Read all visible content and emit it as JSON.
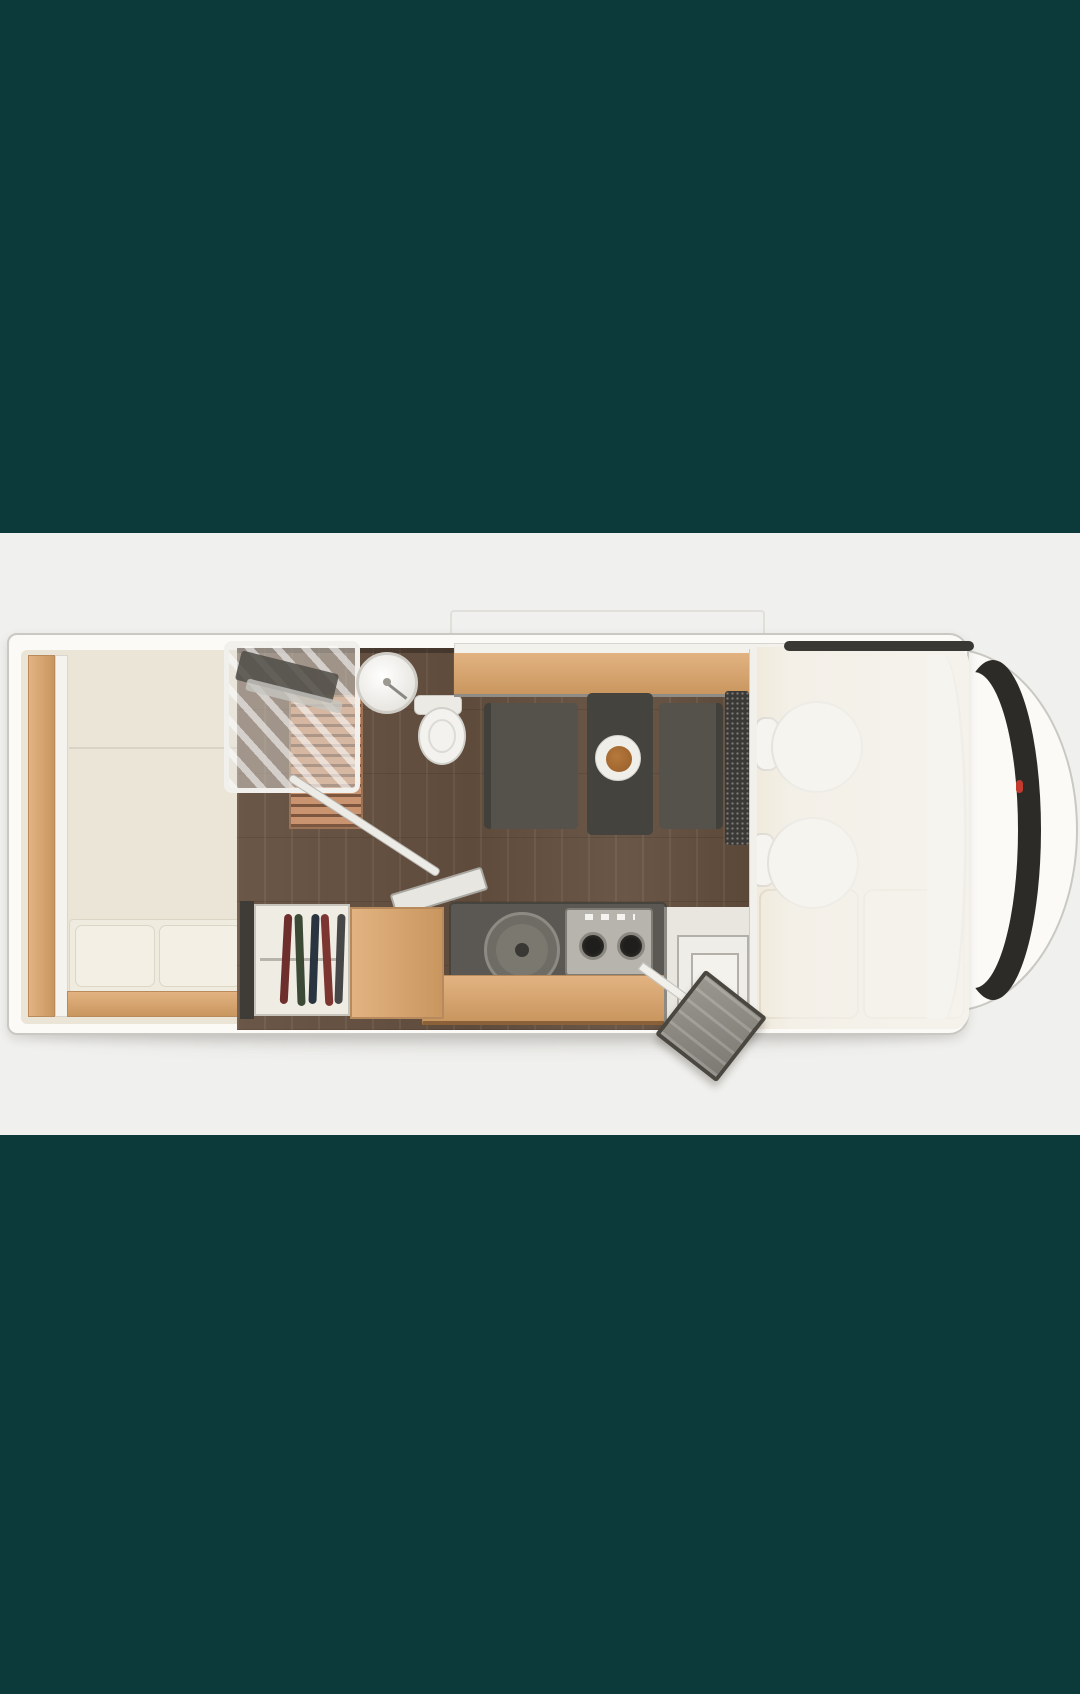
{
  "meta": {
    "title": "Motorhome floor plan, top-down 3D view"
  },
  "objects": [
    "rear-bed",
    "bed-pillows",
    "wardrobe",
    "shower",
    "washbasin",
    "toilet",
    "dinette-table",
    "dinette-benches",
    "overhead-counter",
    "kitchen-sink",
    "gas-stove",
    "kitchen-cabinet",
    "entry-door-open",
    "entry-step",
    "cab-swivel-seats",
    "cab-cushions",
    "dashboard",
    "windshield"
  ],
  "colors": {
    "teal": "#0c3a3b",
    "panel": "#f0f0ee",
    "body": "#fbfaf7",
    "body_line": "#c9c8c2",
    "interior_cream": "#ebe5d7",
    "bed": "#f0ebdf",
    "pillow": "#f3efe4",
    "pillow_line": "#dcd6c5",
    "oak": "#e2b381",
    "oak_deep": "#c9965f",
    "floor": "#6b5747",
    "slat": "#c9946f",
    "slat_gap": "#7c563e",
    "bench": "#55524c",
    "table": "#45433e",
    "plate": "#f0eee8",
    "food": "#a0662f",
    "fabric": "#3b3935",
    "kitchen": "#5b5752",
    "steel": "#b6b4ad",
    "burner": "#1f1e1c",
    "wardrobe": "#efece4",
    "cab_cream": "#efe9d9",
    "windshield": "#2d2b27",
    "door": "#9a978f",
    "door_frame": "#49473f",
    "red_marker": "#c23b2e",
    "shadow": "rgba(70,60,48,0.16)",
    "clothes1": "#6e2f2c",
    "clothes2": "#3c4a35",
    "clothes3": "#2a3440",
    "clothes4": "#7c3531",
    "clothes5": "#474747"
  }
}
